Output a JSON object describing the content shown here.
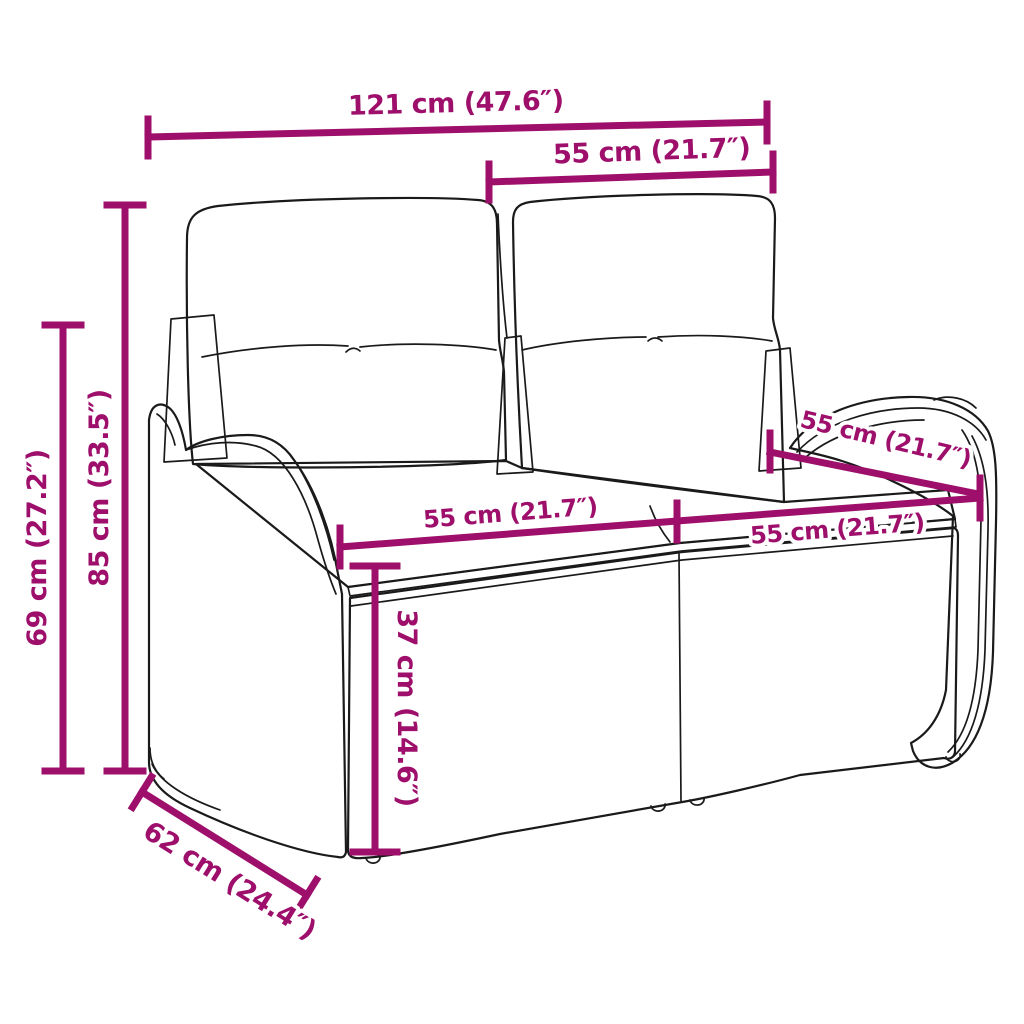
{
  "diagram": {
    "description": "Dimension diagram of a poly rattan 2-seater garden bench with back and seat cushions",
    "colors": {
      "dimension_accent": "#9E0F6B",
      "artwork_outline": "#1A1A1A",
      "background": "#FFFFFF"
    },
    "dimensions": {
      "total_width": {
        "label": "121 cm (47.6″)"
      },
      "backrest_width": {
        "label": "55 cm (21.7″)"
      },
      "total_height": {
        "label": "85 cm (33.5″)"
      },
      "armrest_height": {
        "label": "69 cm (27.2″)"
      },
      "seat_height": {
        "label": "37 cm (14.6″)"
      },
      "seat_width_left": {
        "label": "55 cm (21.7″)"
      },
      "seat_width_right": {
        "label": "55 cm (21.7″)"
      },
      "seat_depth": {
        "label": "55 cm (21.7″)"
      },
      "base_depth": {
        "label": "62 cm (24.4″)"
      }
    }
  }
}
